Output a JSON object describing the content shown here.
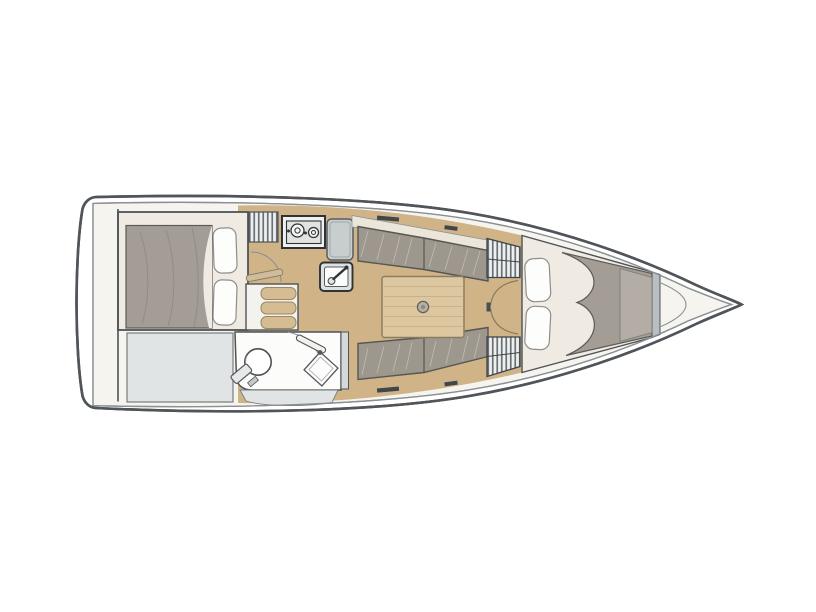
{
  "canvas": {
    "width": 816,
    "height": 612,
    "background": "#ffffff"
  },
  "palette": {
    "outline": "#50555a",
    "inner_line": "#8b9094",
    "hull_white": "#ffffff",
    "deck": "#f6f4ef",
    "wood_floor": "#d0b488",
    "table_wood": "#dcc7a0",
    "step_wood": "#d6bc92",
    "door_wood": "#cdbd9c",
    "cushion": "#9d978e",
    "duvet": "#a39d95",
    "duvet_light": "#b3ada6",
    "cream": "#ece6da",
    "cabin_cream": "#efeae2",
    "pillow": "#fdfdfc",
    "light_gray": "#e1e4e4",
    "counter": "#c7cecd",
    "appliance": "#e2e2e0",
    "stove_face": "#f0f0ee",
    "sink_unit": "#dde1e0",
    "room_white": "#fcfcfb",
    "steps_white": "#f3f2ef",
    "louver_light": "#eef0f0",
    "louver_dark": "#6a7074",
    "window_slit": "#41464a",
    "bulkhead": "#b9bec0",
    "wall_gray": "#d5d9d8",
    "latch": "#4a4f53",
    "fitting": "#b7b1a5"
  },
  "plan": {
    "type": "sailboat interior floor plan",
    "orientation": "bow to the right",
    "areas": [
      {
        "id": "aft-double-cabin",
        "label": "aft double cabin"
      },
      {
        "id": "aft-stowage",
        "label": "aft stowage"
      },
      {
        "id": "head-bathroom",
        "label": "head with toilet and sink"
      },
      {
        "id": "companionway",
        "label": "companionway steps and hatch"
      },
      {
        "id": "galley",
        "label": "galley with stove, counter and sink"
      },
      {
        "id": "saloon",
        "label": "saloon with table and twin settees"
      },
      {
        "id": "lockers",
        "label": "louvered lockers and cabin doors"
      },
      {
        "id": "v-berth",
        "label": "forward V-berth cabin"
      },
      {
        "id": "anchor-locker",
        "label": "bow anchor locker"
      }
    ]
  }
}
